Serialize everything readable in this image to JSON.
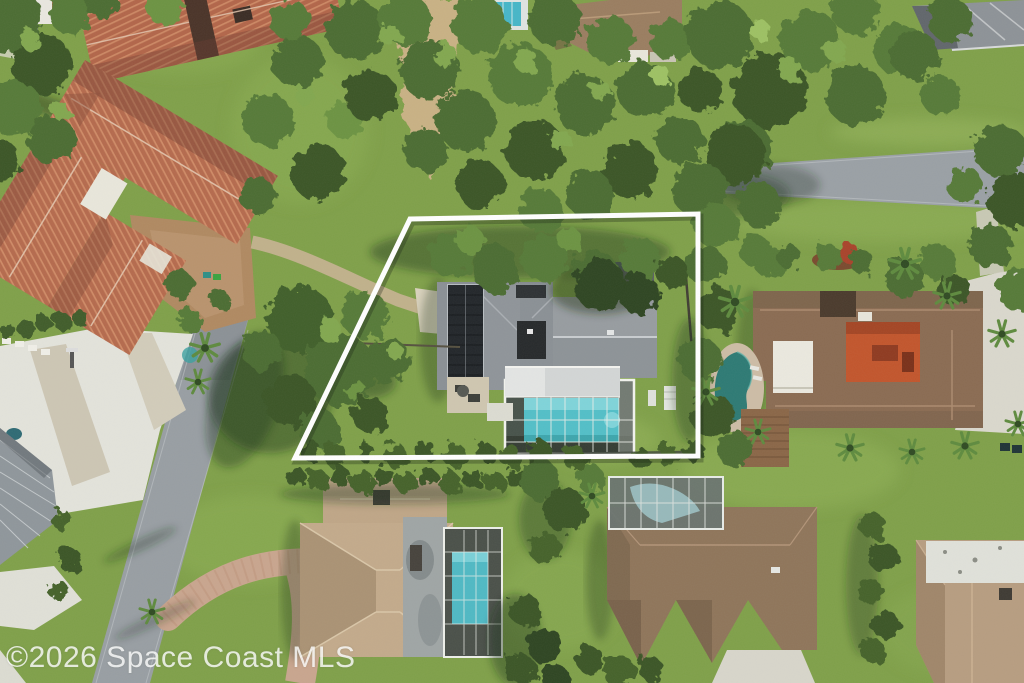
{
  "image": {
    "type": "aerial-photograph",
    "view": "top-down drone view of a suburban residential lot outlined in white",
    "width_px": 1024,
    "height_px": 683
  },
  "watermark": {
    "text": "©2026 Space Coast MLS"
  },
  "scene": {
    "property_boundary": {
      "shape": "white quadrilateral outline",
      "corners_px": [
        [
          410,
          219
        ],
        [
          698,
          214
        ],
        [
          698,
          456
        ],
        [
          295,
          458
        ]
      ]
    },
    "subject_lot_features": [
      "gray shingle roof house",
      "rooftop solar panel array",
      "screened pool enclosure with turquoise rectangular pool",
      "covered lanai",
      "rear lawn",
      "gravel side driveway",
      "mature shade trees"
    ],
    "surroundings": [
      "terracotta tile-roof homes to the northwest",
      "asphalt street running along the southwest",
      "asphalt street along the northeast tree line",
      "east neighbor with orange courtyard and freeform pool",
      "two southern homes with screened pools",
      "dense tree canopy and palm trees",
      "concrete and paver driveways"
    ],
    "palette": {
      "lawn": "#8aaa50",
      "trees": "#4c6c31",
      "road": "#969ca1",
      "concrete": "#e4e4dc",
      "terracotta_roof": "#b56a4d",
      "gray_roof": "#8d9296",
      "tan_roof": "#c3aa8b",
      "brown_roof": "#8f755a",
      "solar_panel": "#23272b",
      "pool_water": "#57c3cb",
      "paver_drive": "#c7a189",
      "boundary": "#ffffff"
    }
  }
}
